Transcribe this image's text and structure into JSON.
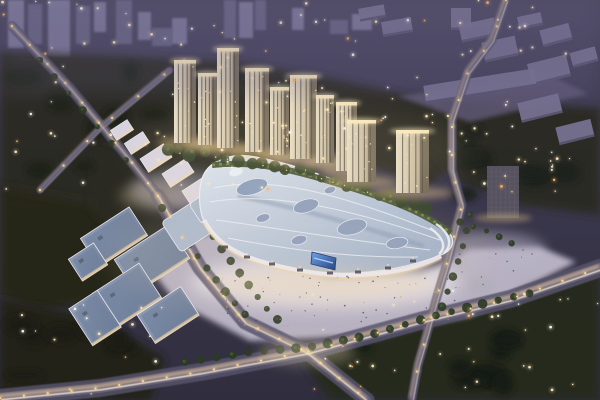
{
  "scene": {
    "width": 600,
    "height": 400,
    "label": "aerial-dusk-rendering-of-mixed-use-mall-and-towers"
  },
  "sky": {
    "stops": [
      [
        0,
        "#4e4a64"
      ],
      [
        0.18,
        "#433f58"
      ],
      [
        0.5,
        "#3a374c"
      ],
      [
        1,
        "#302e3e"
      ]
    ]
  },
  "palette": {
    "roadBed": "#57526a",
    "roadMid": "#6e6880",
    "trailAmber": "#ffd9a0",
    "trailWhite": "#fff3dd",
    "lamp": "#ffd98f",
    "towerFaceA": "#e8dec8",
    "towerFaceB": "#cdbfa4",
    "towerFaceC": "#a2947d",
    "towerShade": "#6f6554",
    "towerStripe": "#514d46",
    "towerCrown": "#f5e6b8",
    "towerGlow": "#ffeec4",
    "towerDot": "#ffe6ad",
    "roofA": "#dde4ef",
    "roofB": "#b6c4d9",
    "roofC": "#93a7c4",
    "roofRib": "#edf2f9",
    "skylight": "#8b9dbd",
    "skylightRim": "#dfe8f4",
    "greenBand": "#41502f",
    "greenDash": "#76894a",
    "facade": "#edeaf2",
    "facadeWarm": "#f0d5a0",
    "blockRoofA": "#8d9bb4",
    "blockRoofB": "#6e7d99",
    "blockEdge": "#e9e7f0",
    "blockWarm": "#eed2a0",
    "blockUnit": "#5a6478",
    "retailRoof": "#dfdae8",
    "retailEdge": "#f6f4f9",
    "retailWarm": "#f2d6a2",
    "warehouseTop": "#767190",
    "warehouseSide": "#55516a",
    "distantA": "#837fa0",
    "distantB": "#6c6888",
    "officeBody": "#56525f",
    "officeGrid": "#67636f",
    "treeBlob": "#2d3a25",
    "treeHi": "#465c33",
    "baseTree": "#35422a",
    "baseTreeHi": "#4f6234",
    "crowdDark": "#49445a",
    "crowdWarm": "#c9a36a",
    "screenA": "#5a9af2",
    "screenB": "#0c2f7a",
    "screenStreak": "#a8dcff",
    "screenFrame": "#0d2a66",
    "haze": "#6a6488",
    "field": "#5e5975"
  },
  "light_colors": [
    "#ffe9b8",
    "#fff8ee",
    "#ffb45e"
  ],
  "seed": 7,
  "distant_buildings": [
    [
      8,
      0,
      16,
      48
    ],
    [
      28,
      4,
      14,
      40
    ],
    [
      48,
      0,
      22,
      57
    ],
    [
      76,
      6,
      14,
      38
    ],
    [
      94,
      2,
      12,
      30
    ],
    [
      116,
      0,
      16,
      44
    ],
    [
      138,
      12,
      13,
      28
    ],
    [
      152,
      28,
      20,
      18
    ],
    [
      172,
      18,
      15,
      26
    ],
    [
      224,
      0,
      12,
      38
    ],
    [
      239,
      2,
      14,
      36
    ],
    [
      255,
      0,
      11,
      30
    ],
    [
      292,
      8,
      12,
      22
    ],
    [
      330,
      20,
      18,
      14
    ],
    [
      352,
      14,
      20,
      16
    ]
  ],
  "tree_masses": [
    {
      "pts": [
        [
          0,
          52
        ],
        [
          120,
          56
        ],
        [
          230,
          62
        ],
        [
          320,
          118
        ],
        [
          300,
          150
        ],
        [
          200,
          185
        ],
        [
          110,
          205
        ],
        [
          0,
          190
        ]
      ],
      "fill": "#2b2c23"
    },
    {
      "pts": [
        [
          0,
          185
        ],
        [
          110,
          205
        ],
        [
          150,
          250
        ],
        [
          120,
          300
        ],
        [
          40,
          310
        ],
        [
          0,
          295
        ]
      ],
      "fill": "#252618"
    },
    {
      "pts": [
        [
          235,
          62
        ],
        [
          330,
          78
        ],
        [
          430,
          100
        ],
        [
          470,
          150
        ],
        [
          430,
          185
        ],
        [
          350,
          160
        ],
        [
          300,
          125
        ],
        [
          260,
          95
        ]
      ],
      "fill": "#2a2b21"
    },
    {
      "pts": [
        [
          440,
          98
        ],
        [
          600,
          108
        ],
        [
          600,
          215
        ],
        [
          520,
          205
        ],
        [
          455,
          180
        ],
        [
          430,
          150
        ]
      ],
      "fill": "#2b2c22"
    },
    {
      "pts": [
        [
          300,
          358
        ],
        [
          420,
          325
        ],
        [
          520,
          297
        ],
        [
          600,
          268
        ],
        [
          600,
          400
        ],
        [
          330,
          400
        ]
      ],
      "fill": "#272a1e"
    },
    {
      "pts": [
        [
          0,
          298
        ],
        [
          95,
          318
        ],
        [
          165,
          358
        ],
        [
          150,
          400
        ],
        [
          0,
          400
        ]
      ],
      "fill": "#222416"
    },
    {
      "pts": [
        [
          95,
          150
        ],
        [
          160,
          178
        ],
        [
          195,
          235
        ],
        [
          150,
          258
        ],
        [
          90,
          210
        ]
      ],
      "fill": "#2b2c21"
    }
  ],
  "tree_clump_regions": [
    {
      "x": 20,
      "y": 70,
      "w": 260,
      "h": 110,
      "count": 12,
      "fill": "#1f2019"
    },
    {
      "x": 310,
      "y": 285,
      "w": 270,
      "h": 100,
      "count": 14,
      "fill": "#191c12"
    },
    {
      "x": 445,
      "y": 110,
      "w": 140,
      "h": 85,
      "count": 9,
      "fill": "#1f211a"
    },
    {
      "x": 10,
      "y": 305,
      "w": 140,
      "h": 80,
      "count": 7,
      "fill": "#1b1d12"
    }
  ],
  "field_polygon": {
    "pts": [
      [
        398,
        96
      ],
      [
        552,
        76
      ],
      [
        588,
        94
      ],
      [
        470,
        122
      ]
    ],
    "fill": "#5e5975",
    "op": 0.85
  },
  "plaza_shapes": [
    {
      "pts": [
        [
          140,
          255
        ],
        [
          210,
          233
        ],
        [
          262,
          258
        ],
        [
          330,
          280
        ],
        [
          420,
          276
        ],
        [
          470,
          249
        ],
        [
          540,
          247
        ],
        [
          576,
          262
        ],
        [
          470,
          316
        ],
        [
          360,
          336
        ],
        [
          250,
          341
        ],
        [
          175,
          301
        ]
      ],
      "fill": "#cdc7d8",
      "op": 0.85,
      "blur": 3
    },
    {
      "ellipse": [
        325,
        282,
        135,
        26
      ],
      "fill": "#e9e5ee",
      "op": 0.75,
      "blur": 8
    },
    {
      "ellipse": [
        490,
        250,
        55,
        18
      ],
      "fill": "#b9b3c8",
      "op": 0.55,
      "blur": 6
    },
    {
      "ellipse": [
        182,
        190,
        52,
        20
      ],
      "fill": "#b5aec4",
      "op": 0.5,
      "blur": 6
    }
  ],
  "roads": [
    {
      "pts": [
        [
          12,
          26
        ],
        [
          70,
          88
        ],
        [
          130,
          160
        ],
        [
          158,
          196
        ]
      ],
      "w": 10,
      "bright": 0.6,
      "lampStep": 26
    },
    {
      "pts": [
        [
          40,
          190
        ],
        [
          100,
          128
        ],
        [
          170,
          70
        ]
      ],
      "w": 7,
      "bright": 0.45,
      "lampStep": 34
    },
    {
      "pts": [
        [
          158,
          196
        ],
        [
          200,
          268
        ],
        [
          245,
          322
        ],
        [
          307,
          352
        ],
        [
          367,
          400
        ]
      ],
      "w": 15,
      "bright": 0.9,
      "lampStep": 24
    },
    {
      "pts": [
        [
          0,
          398
        ],
        [
          100,
          388
        ],
        [
          200,
          372
        ],
        [
          307,
          352
        ],
        [
          420,
          321
        ],
        [
          510,
          299
        ],
        [
          600,
          268
        ]
      ],
      "w": 18,
      "bright": 1.0,
      "lampStep": 24
    },
    {
      "pts": [
        [
          506,
          0
        ],
        [
          492,
          40
        ],
        [
          468,
          72
        ],
        [
          452,
          120
        ],
        [
          452,
          170
        ],
        [
          462,
          205
        ],
        [
          448,
          260
        ],
        [
          436,
          300
        ],
        [
          428,
          330
        ],
        [
          418,
          365
        ],
        [
          412,
          398
        ]
      ],
      "w": 9,
      "bright": 0.7,
      "lampStep": 28
    }
  ],
  "tree_lines": [
    {
      "pts": [
        [
          185,
          362
        ],
        [
          250,
          352
        ],
        [
          310,
          347
        ],
        [
          370,
          335
        ],
        [
          430,
          317
        ],
        [
          490,
          302
        ],
        [
          545,
          290
        ]
      ],
      "r": 4,
      "step": 16
    },
    {
      "pts": [
        [
          162,
          208
        ],
        [
          185,
          240
        ],
        [
          210,
          272
        ],
        [
          232,
          300
        ],
        [
          252,
          322
        ]
      ],
      "r": 3.5,
      "step": 15
    },
    {
      "pts": [
        [
          196,
          212
        ],
        [
          218,
          244
        ],
        [
          242,
          276
        ],
        [
          266,
          308
        ],
        [
          288,
          330
        ]
      ],
      "r": 3.5,
      "step": 15
    },
    {
      "pts": [
        [
          40,
          60
        ],
        [
          70,
          95
        ],
        [
          100,
          130
        ],
        [
          128,
          162
        ]
      ],
      "r": 3,
      "step": 22
    },
    {
      "pts": [
        [
          470,
          215
        ],
        [
          462,
          250
        ],
        [
          450,
          285
        ],
        [
          440,
          312
        ]
      ],
      "r": 3.5,
      "step": 16
    },
    {
      "pts": [
        [
          460,
          222
        ],
        [
          490,
          232
        ],
        [
          515,
          245
        ]
      ],
      "r": 3,
      "step": 14
    }
  ],
  "left_complex": [
    [
      114,
      237,
      58,
      34
    ],
    [
      152,
      259,
      64,
      40
    ],
    [
      127,
      296,
      56,
      42
    ],
    [
      168,
      315,
      52,
      34
    ],
    [
      193,
      227,
      40,
      26
    ],
    [
      95,
      318,
      34,
      44
    ],
    [
      88,
      262,
      30,
      26
    ]
  ],
  "retail_blocks": [
    [
      137,
      143,
      22,
      13
    ],
    [
      156,
      158,
      28,
      16
    ],
    [
      178,
      173,
      28,
      16
    ],
    [
      199,
      190,
      30,
      17
    ],
    [
      218,
      208,
      28,
      16
    ],
    [
      234,
      224,
      24,
      14
    ],
    [
      122,
      130,
      20,
      12
    ]
  ],
  "warehouses": [
    [
      372,
      13,
      26,
      13,
      -10
    ],
    [
      397,
      27,
      30,
      15,
      -10
    ],
    [
      461,
      19,
      20,
      22,
      0
    ],
    [
      478,
      30,
      36,
      18,
      -12
    ],
    [
      500,
      49,
      34,
      20,
      -12
    ],
    [
      556,
      35,
      30,
      17,
      -15
    ],
    [
      584,
      57,
      26,
      15,
      -15
    ],
    [
      530,
      21,
      24,
      13,
      -12
    ],
    [
      549,
      70,
      40,
      22,
      -14
    ],
    [
      480,
      86,
      112,
      18,
      -9
    ],
    [
      540,
      108,
      42,
      20,
      -14
    ],
    [
      575,
      132,
      36,
      18,
      -14
    ]
  ],
  "mall": {
    "roof_path": "M 203,176 C 210,160 232,152 256,157 C 292,164 318,173 350,187 C 384,201 424,212 446,230 C 456,238 455,249 441,255 C 418,264 390,271 356,273 C 318,275 282,268 252,257 C 228,248 208,234 202,216 C 198,202 199,186 203,176 Z",
    "ribs": [
      "M 214,188 C 268,176 330,190 436,232",
      "M 210,202 C 266,192 336,204 440,240",
      "M 216,220 C 276,228 348,240 430,250",
      "M 228,238 C 290,250 352,258 418,257",
      "M 222,168 C 262,160 300,168 340,182"
    ],
    "spine": "M 238,196 C 300,208 360,226 424,246",
    "skylights": [
      [
        252,
        187,
        16,
        7.5,
        -16
      ],
      [
        306,
        206,
        13,
        6.5,
        -16
      ],
      [
        352,
        227,
        15,
        7.5,
        -14
      ],
      [
        397,
        243,
        11,
        5.5,
        -10
      ],
      [
        299,
        240,
        8,
        4.5,
        -14
      ],
      [
        263,
        218,
        7,
        4,
        -16
      ],
      [
        330,
        190,
        6,
        3.5,
        -16
      ]
    ],
    "pods": [
      [
        236,
        172,
        7,
        4,
        -16
      ],
      [
        274,
        166,
        6,
        3.5,
        -16
      ]
    ],
    "green_band": "M 212,165 C 260,160 300,172 345,186 C 388,199 424,212 451,233",
    "facade": "M 204,220 C 214,240 232,252 256,260 C 292,271 330,277 362,275 C 398,273 424,265 441,256",
    "entrances": [
      [
        225,
        247
      ],
      [
        247,
        257
      ],
      [
        272,
        264
      ],
      [
        300,
        270
      ],
      [
        330,
        273
      ],
      [
        358,
        272
      ],
      [
        388,
        268
      ],
      [
        413,
        261
      ]
    ],
    "terraces": [
      "M 430,228 C 443,237 447,247 439,254",
      "M 436,224 C 450,233 453,245 444,253"
    ],
    "left_wing": [
      [
        187,
        227,
        38,
        36
      ],
      [
        208,
        206,
        30,
        24
      ]
    ],
    "screen": {
      "pts": [
        [
          312,
          252
        ],
        [
          336,
          258
        ],
        [
          335,
          270
        ],
        [
          311,
          264
        ]
      ]
    },
    "glow": [
      322,
      284,
      112,
      16
    ]
  },
  "towers": [
    [
      174,
      60,
      22,
      143
    ],
    [
      198,
      73,
      19,
      145
    ],
    [
      217,
      48,
      22,
      148
    ],
    [
      245,
      68,
      24,
      152
    ],
    [
      270,
      87,
      19,
      155
    ],
    [
      290,
      75,
      27,
      159
    ],
    [
      316,
      95,
      18,
      163
    ],
    [
      336,
      102,
      21,
      171
    ],
    [
      347,
      120,
      29,
      182
    ],
    [
      396,
      130,
      33,
      193
    ]
  ],
  "office_tower": {
    "x": 487,
    "y": 166,
    "w": 32,
    "h": 52
  },
  "base_trees": {
    "pts": [
      [
        168,
        150
      ],
      [
        215,
        155
      ],
      [
        260,
        163
      ],
      [
        305,
        172
      ],
      [
        350,
        185
      ],
      [
        400,
        200
      ],
      [
        435,
        210
      ]
    ],
    "step": 12
  },
  "scatter_lights": [
    {
      "x": 0,
      "y": 0,
      "w": 600,
      "h": 58,
      "count": 46
    },
    {
      "x": 0,
      "y": 60,
      "w": 300,
      "h": 140,
      "count": 40
    },
    {
      "x": 250,
      "y": 70,
      "w": 180,
      "h": 90,
      "count": 22
    },
    {
      "x": 430,
      "y": 100,
      "w": 170,
      "h": 100,
      "count": 28
    },
    {
      "x": 310,
      "y": 280,
      "w": 290,
      "h": 115,
      "count": 34
    },
    {
      "x": 0,
      "y": 300,
      "w": 170,
      "h": 95,
      "count": 16
    }
  ],
  "crowd_regions": [
    [
      218,
      276,
      240,
      50,
      70
    ],
    [
      455,
      248,
      80,
      40,
      18
    ]
  ],
  "glows": [
    {
      "e": [
        300,
        255,
        190,
        60
      ],
      "fill": "#eed9b8",
      "op": 0.13,
      "blur": 14
    },
    {
      "e": [
        300,
        150,
        170,
        45
      ],
      "fill": "#ffe8bc",
      "op": 0.1,
      "blur": 14
    },
    {
      "e": [
        158,
        196,
        40,
        14
      ],
      "fill": "#f7dfae",
      "op": 0.25,
      "blur": 6
    },
    {
      "e": [
        307,
        352,
        48,
        14
      ],
      "fill": "#f7e3bb",
      "op": 0.28,
      "blur": 6
    }
  ],
  "haze_band": {
    "x": 0,
    "y": 0,
    "w": 600,
    "h": 95,
    "op": 0.22
  }
}
